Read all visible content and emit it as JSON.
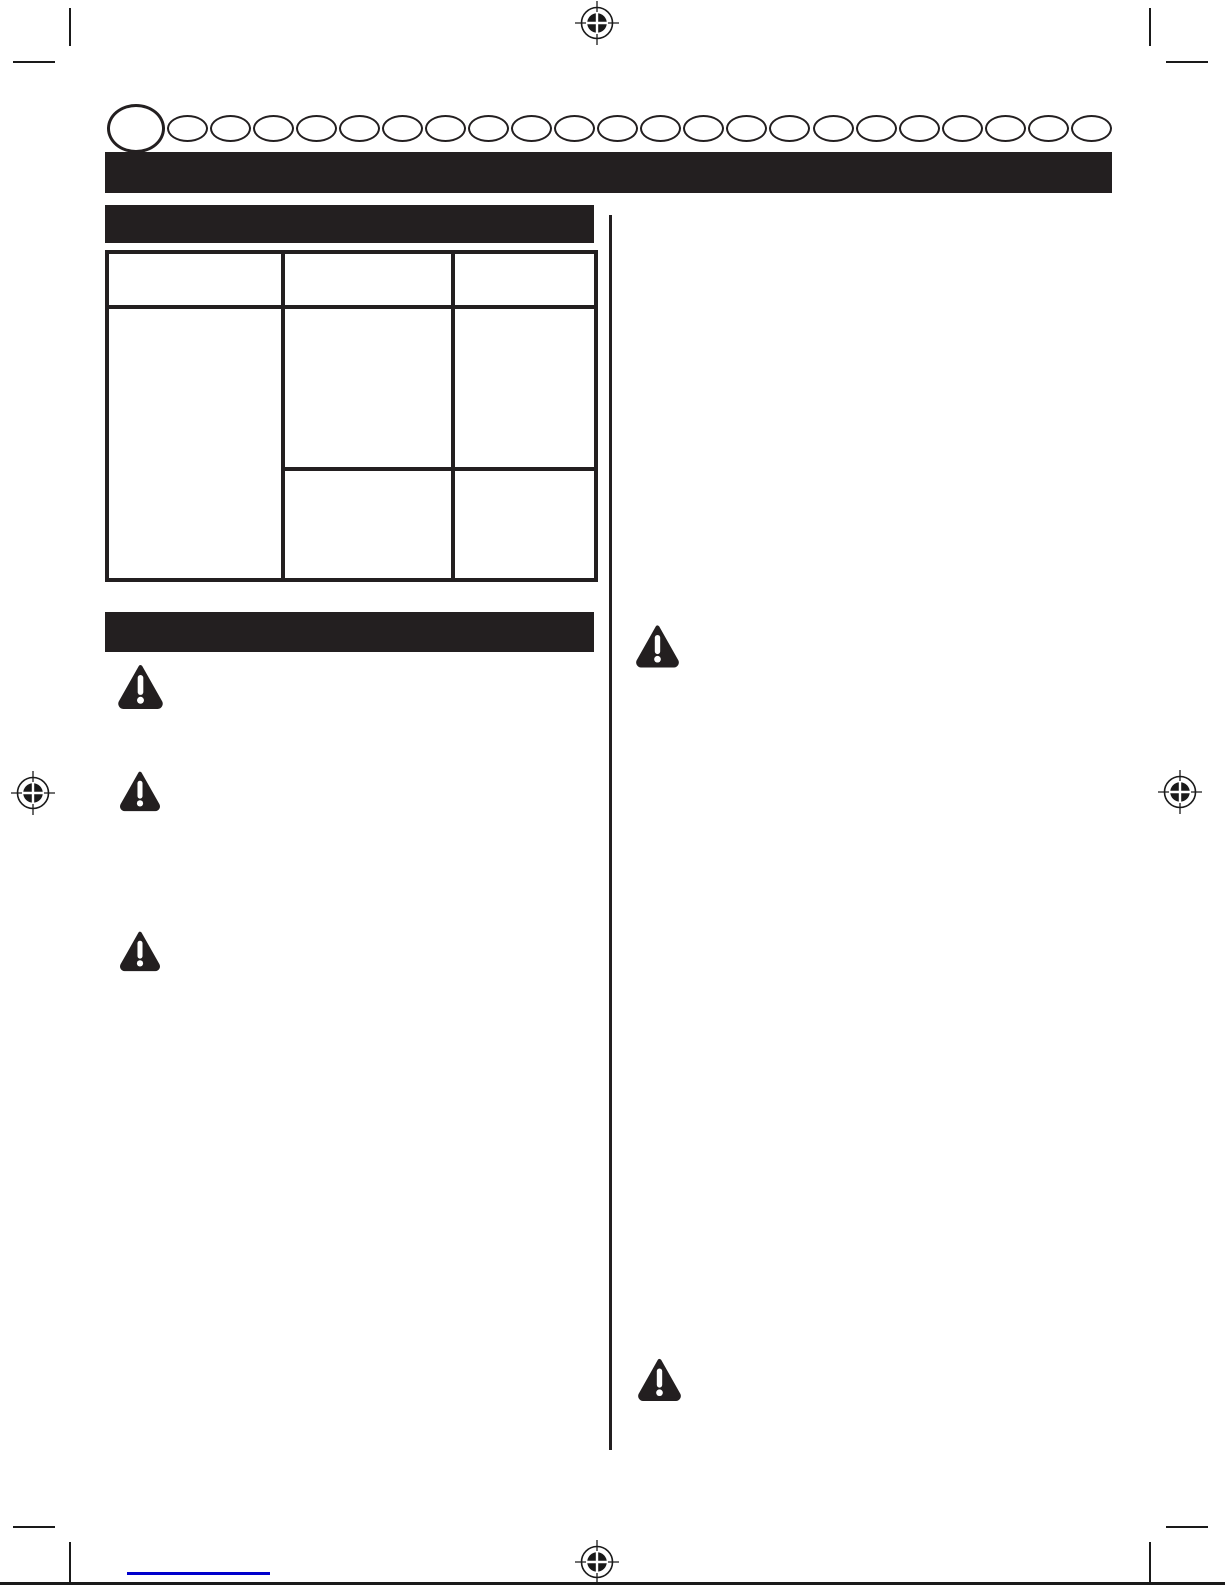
{
  "page": {
    "background_color": "#ffffff",
    "ink_color": "#231f20",
    "content_note": "printed manual page; all body text is blank in the scan"
  },
  "print_marks": {
    "registration_mark_icon": "registration-target-icon",
    "registration_mark_count": 4,
    "crop_mark_corner_count": 4
  },
  "language_tab_row": {
    "tab_shape": "ellipse-outline",
    "large_tab_count": 1,
    "small_tab_count": 22
  },
  "page_title_bar": {
    "text": ""
  },
  "left_column": {
    "section_bar_1": {
      "text": ""
    },
    "spec_table": {
      "column_count": 3,
      "header_cells": [
        "",
        "",
        ""
      ],
      "cell_text": "",
      "structure": "column 1 spans two body rows; columns 2 and 3 each split into two stacked cells"
    },
    "section_bar_2": {
      "text": ""
    },
    "warning_icon": "warning-triangle-icon",
    "warning_icon_count": 3
  },
  "right_column": {
    "warning_icon": "warning-triangle-icon",
    "warning_icon_count": 2
  },
  "footer": {
    "link_underline_color": "#0000cc",
    "link_text": ""
  }
}
